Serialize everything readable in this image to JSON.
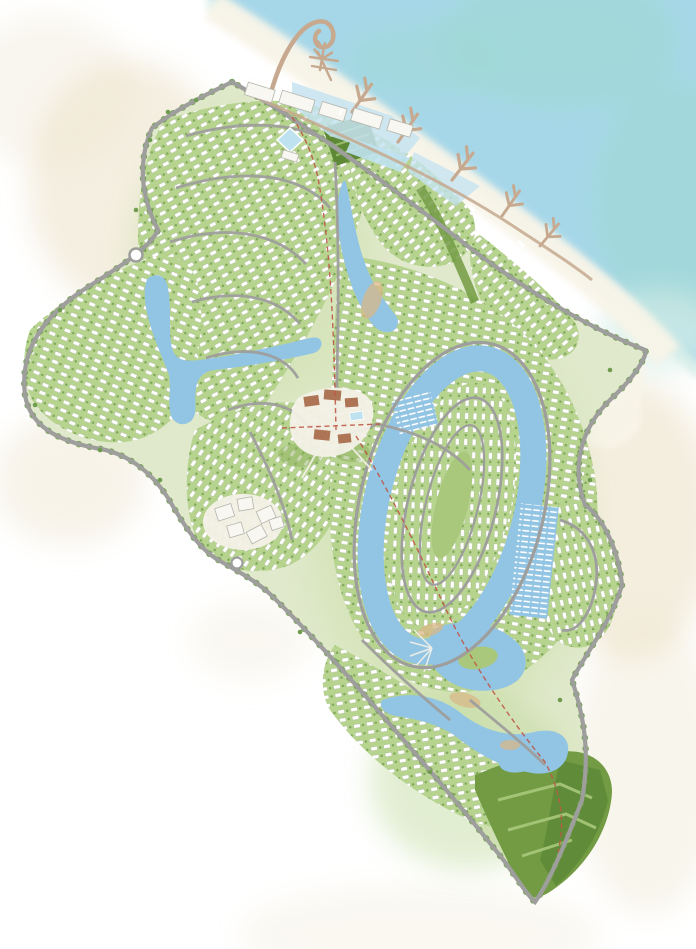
{
  "canvas": {
    "width": 696,
    "height": 949
  },
  "map": {
    "kind": "resort-masterplan-illustration",
    "palette": {
      "background": "#ffffff",
      "sand": "#ece2c9",
      "sea": "#a6d7e9",
      "sea_teal": "#9fd9d0",
      "sea_pale": "#d3ece6",
      "beach": "#f8f4e8",
      "land": "#e0e9cb",
      "green_light": "#cde0ab",
      "green": "#b7d48e",
      "green_dark": "#8db05e",
      "park": "#729b43",
      "park_dark": "#5d8836",
      "park_light": "#a9c87c",
      "lagoon": "#92c4e3",
      "lagoon_light": "#c5e3f0",
      "pool": "#bfe2f0",
      "road": "#9e9e9c",
      "house": "#ffffff",
      "house_stroke": "#a2b18d",
      "tree": "#6f9c4f",
      "pier": "#c6a98f",
      "dune": "#d9b988",
      "building": "#f8f7f2",
      "building_stroke": "#b5b5ad",
      "terracotta": "#a96f4d",
      "plaza": "#f3f1e7",
      "path_red": "#bf5746"
    },
    "features": [
      {
        "name": "sea",
        "color_key": "sea"
      },
      {
        "name": "beach",
        "color_key": "beach"
      },
      {
        "name": "marina-breakwater",
        "color_key": "pier"
      },
      {
        "name": "finger-piers",
        "color_key": "pier"
      },
      {
        "name": "waterfront-buildings",
        "color_key": "building"
      },
      {
        "name": "marina-basin",
        "color_key": "lagoon_light"
      },
      {
        "name": "formal-garden",
        "color_key": "park_dark"
      },
      {
        "name": "beach-club-pavilion",
        "color_key": "pool"
      },
      {
        "name": "north-village",
        "color_key": "green"
      },
      {
        "name": "west-arm-villas",
        "color_key": "green"
      },
      {
        "name": "southwest-village",
        "color_key": "green"
      },
      {
        "name": "hotel-cluster",
        "color_key": "building"
      },
      {
        "name": "town-center",
        "color_key": "terracotta"
      },
      {
        "name": "winding-lagoon",
        "color_key": "lagoon"
      },
      {
        "name": "central-lagoon-loop",
        "color_key": "lagoon"
      },
      {
        "name": "island-village",
        "color_key": "green"
      },
      {
        "name": "boat-docks",
        "color_key": "house"
      },
      {
        "name": "east-bulge-village",
        "color_key": "green"
      },
      {
        "name": "south-village",
        "color_key": "green"
      },
      {
        "name": "golf-pond",
        "color_key": "lagoon"
      },
      {
        "name": "tip-park",
        "color_key": "park"
      },
      {
        "name": "perimeter-road",
        "color_key": "road"
      },
      {
        "name": "pedestrian-spine",
        "color_key": "path_red"
      },
      {
        "name": "tree-line",
        "color_key": "tree"
      }
    ]
  }
}
